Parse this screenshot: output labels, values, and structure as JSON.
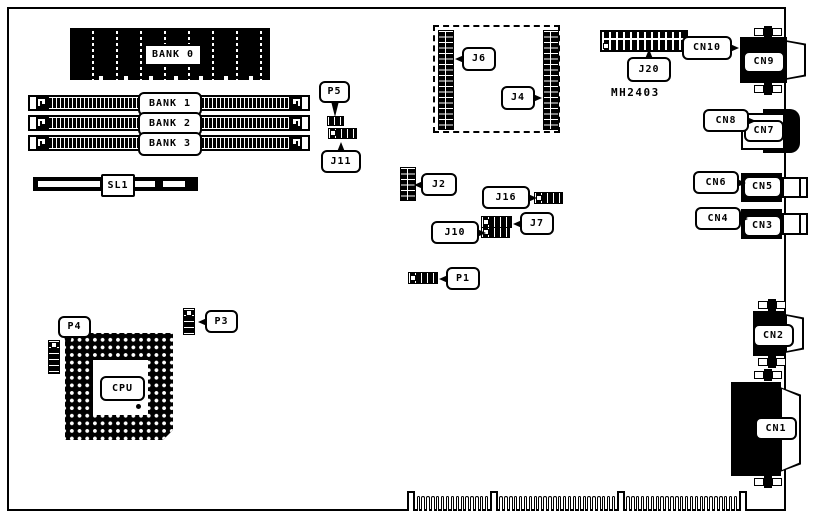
{
  "memory": [
    "BANK 0",
    "BANK 1",
    "BANK 2",
    "BANK 3"
  ],
  "slot": "SL1",
  "cpu": "CPU",
  "chip": "MH2403",
  "jumpers": {
    "p5": "P5",
    "j11": "J11",
    "j6": "J6",
    "j4": "J4",
    "j20": "J20",
    "j2": "J2",
    "j16": "J16",
    "j7": "J7",
    "j10": "J10",
    "p1": "P1",
    "p4": "P4",
    "p3": "P3"
  },
  "connectors": {
    "cn1": "CN1",
    "cn2": "CN2",
    "cn3": "CN3",
    "cn4": "CN4",
    "cn5": "CN5",
    "cn6": "CN6",
    "cn7": "CN7",
    "cn8": "CN8",
    "cn9": "CN9",
    "cn10": "CN10"
  },
  "colors": {
    "ink": "#000000",
    "paper": "#ffffff"
  }
}
